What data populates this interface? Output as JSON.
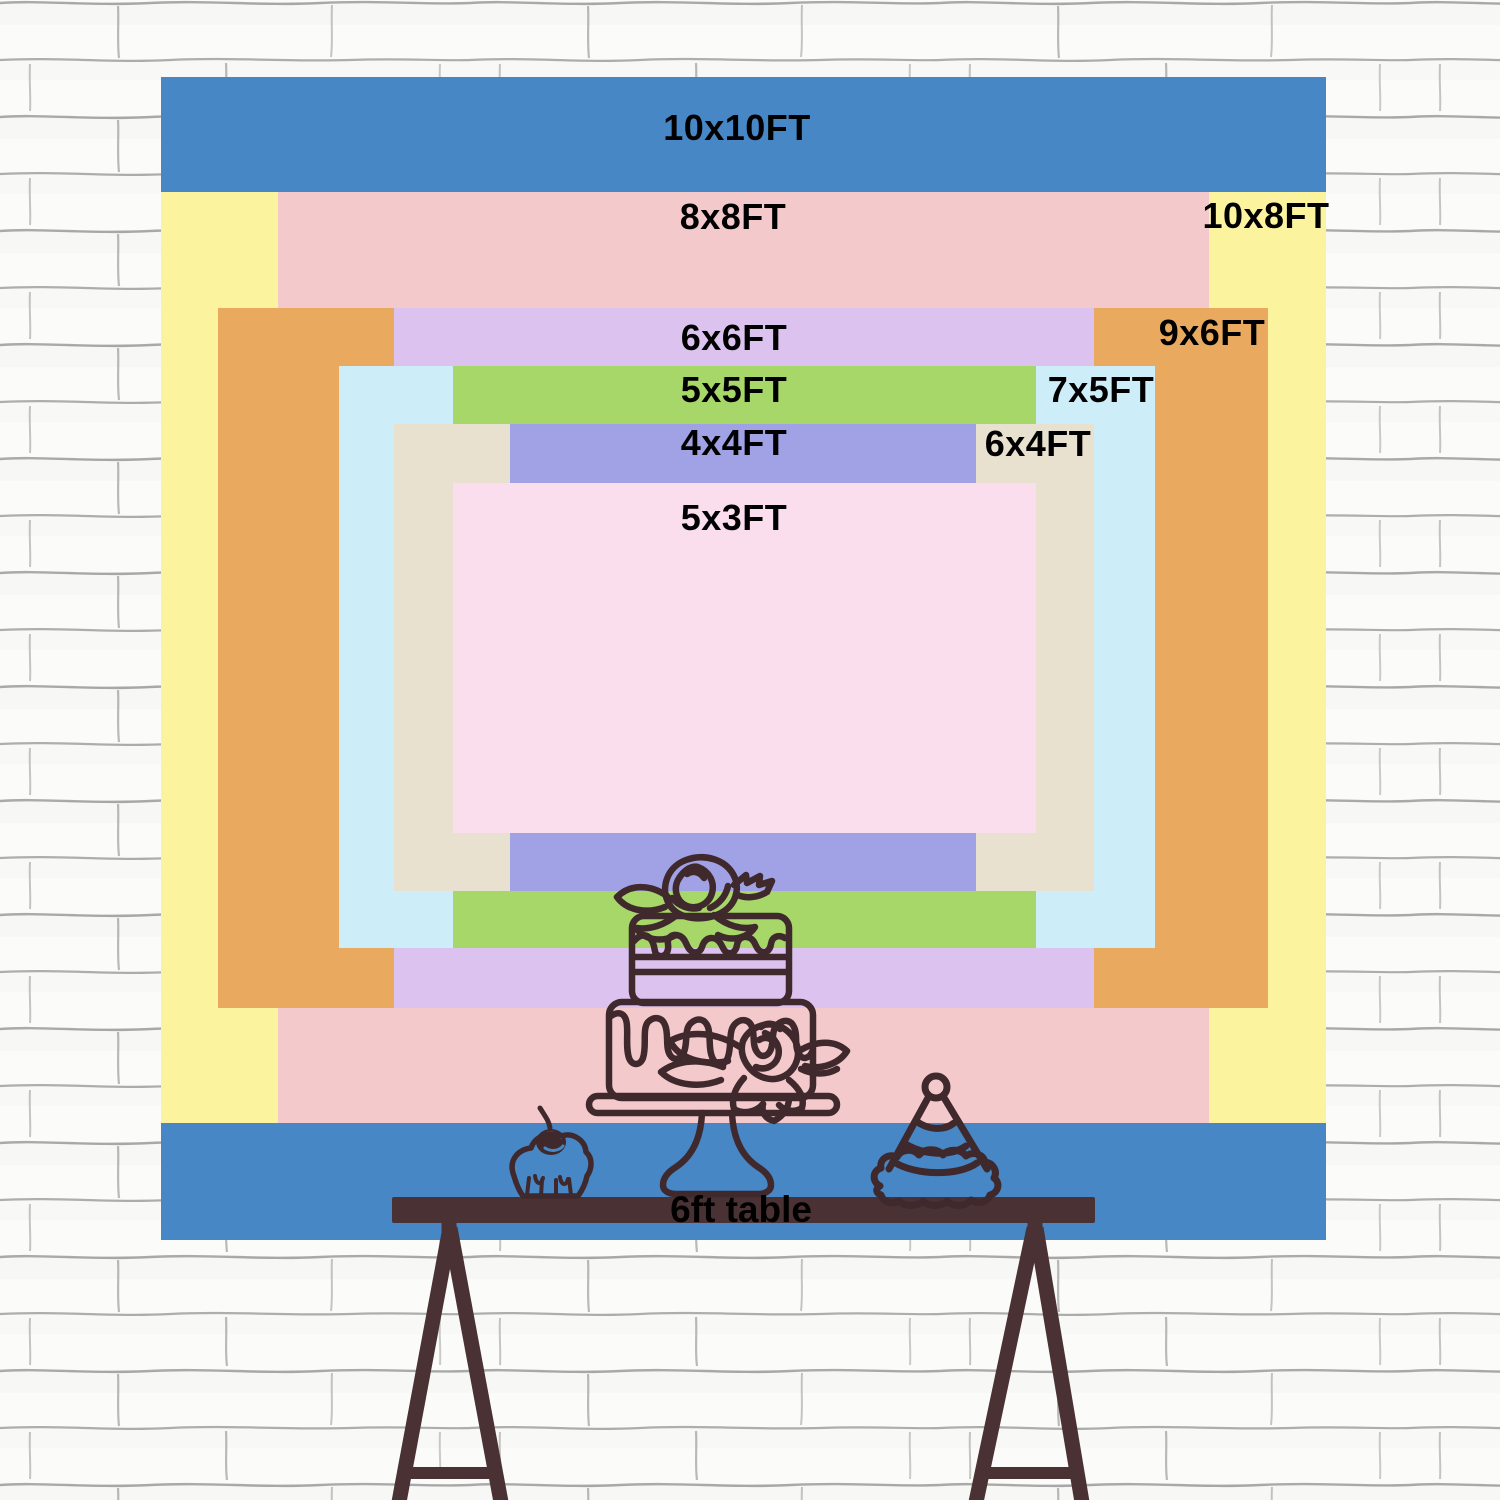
{
  "sizes": [
    {
      "id": "10x10",
      "label": "10x10FT",
      "width_ft": 10,
      "height_ft": 10,
      "color": "#4787c6"
    },
    {
      "id": "10x8",
      "label": "10x8FT",
      "width_ft": 10,
      "height_ft": 8,
      "color": "#fcf39f"
    },
    {
      "id": "8x8",
      "label": "8x8FT",
      "width_ft": 8,
      "height_ft": 8,
      "color": "#f4c9cc"
    },
    {
      "id": "9x6",
      "label": "9x6FT",
      "width_ft": 9,
      "height_ft": 6,
      "color": "#e9a95e"
    },
    {
      "id": "6x6",
      "label": "6x6FT",
      "width_ft": 6,
      "height_ft": 6,
      "color": "#dcc2ef"
    },
    {
      "id": "7x5",
      "label": "7x5FT",
      "width_ft": 7,
      "height_ft": 5,
      "color": "#cdedf8"
    },
    {
      "id": "5x5",
      "label": "5x5FT",
      "width_ft": 5,
      "height_ft": 5,
      "color": "#a7d768"
    },
    {
      "id": "6x4",
      "label": "6x4FT",
      "width_ft": 6,
      "height_ft": 4,
      "color": "#e9e1cf"
    },
    {
      "id": "4x4",
      "label": "4x4FT",
      "width_ft": 4,
      "height_ft": 4,
      "color": "#a1a2e5"
    },
    {
      "id": "5x3",
      "label": "5x3FT",
      "width_ft": 5,
      "height_ft": 3,
      "color": "#fbdeee"
    }
  ],
  "table": {
    "label": "6ft table",
    "color": "#4a3134"
  },
  "artwork": {
    "stroke_color": "#3f292d",
    "icons": [
      "tiered-cake-icon",
      "cupcake-icon",
      "party-hat-icon"
    ]
  },
  "wall": {
    "background": "#fbfbfa",
    "mortar_line": "#8e8e8e"
  },
  "label_text_color": "#000000"
}
